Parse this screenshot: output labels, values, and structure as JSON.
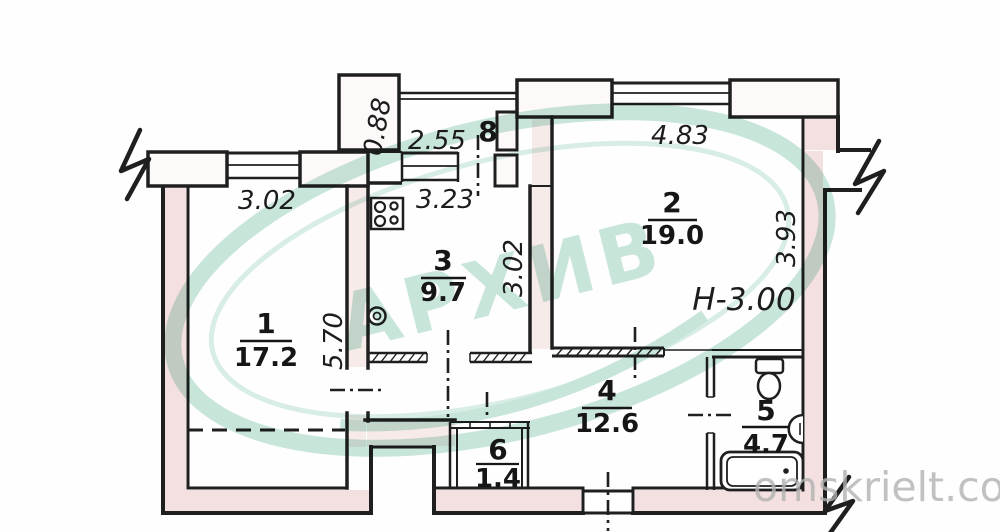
{
  "watermarks": {
    "stamp": "АРХИВ",
    "site": "omskrielt.com"
  },
  "plan": {
    "height_note": "Н-3.00",
    "rooms": {
      "r1": {
        "number": "1",
        "area": "17.2"
      },
      "r2": {
        "number": "2",
        "area": "19.0"
      },
      "r3": {
        "number": "3",
        "area": "9.7"
      },
      "r4": {
        "number": "4",
        "area": "12.6"
      },
      "r5": {
        "number": "5",
        "area": "4.7"
      },
      "r6": {
        "number": "6",
        "area": "1.4"
      },
      "r8": {
        "number": "8"
      }
    },
    "dimensions": {
      "room1_width": "3.02",
      "room1_depth": "5.70",
      "room2_width": "4.83",
      "room2_depth": "3.93",
      "kitchen_width": "3.23",
      "kitchen_depth": "3.02",
      "balcony_width": "2.55",
      "balcony_side": "0.88"
    }
  }
}
